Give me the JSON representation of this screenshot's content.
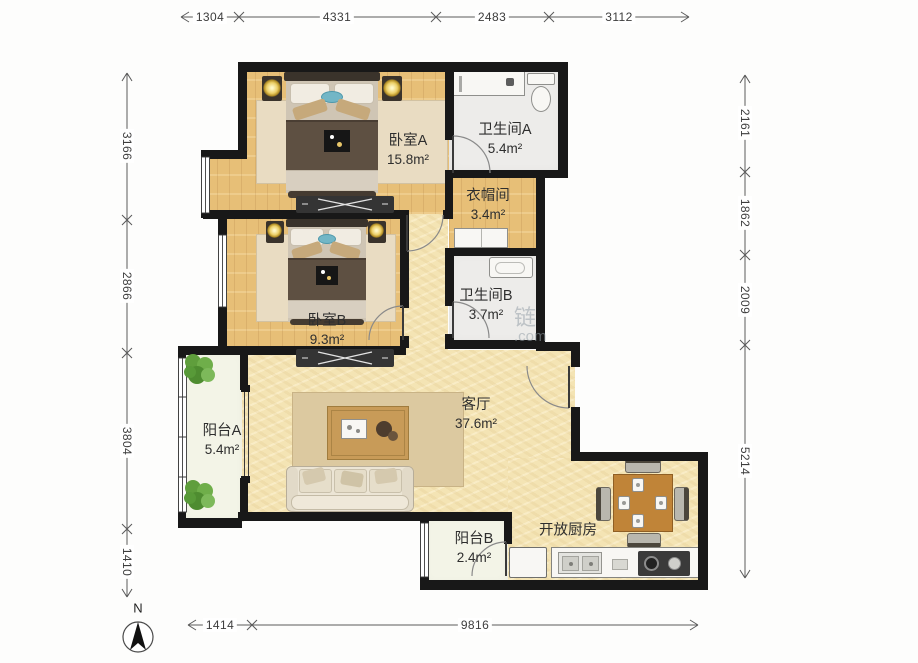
{
  "compass": {
    "label": "N"
  },
  "dimensions": {
    "top": [
      "1304",
      "4331",
      "2483",
      "3112"
    ],
    "left": [
      "3166",
      "2866",
      "3804",
      "1410"
    ],
    "right": [
      "2161",
      "1862",
      "2009",
      "5214"
    ],
    "bottom": [
      "1414",
      "9816"
    ]
  },
  "rooms": {
    "bedroomA": {
      "name": "卧室A",
      "area": "15.8m²"
    },
    "bathroomA": {
      "name": "卫生间A",
      "area": "5.4m²"
    },
    "cloakroom": {
      "name": "衣帽间",
      "area": "3.4m²"
    },
    "bedroomB": {
      "name": "卧室B",
      "area": "9.3m²"
    },
    "bathroomB": {
      "name": "卫生间B",
      "area": "3.7m²"
    },
    "balconyA": {
      "name": "阳台A",
      "area": "5.4m²"
    },
    "living": {
      "name": "客厅",
      "area": "37.6m²"
    },
    "balconyB": {
      "name": "阳台B",
      "area": "2.4m²"
    },
    "kitchen": {
      "name": "开放厨房",
      "area": ""
    }
  },
  "watermark": {
    "char": "链",
    "domain": ".com"
  }
}
